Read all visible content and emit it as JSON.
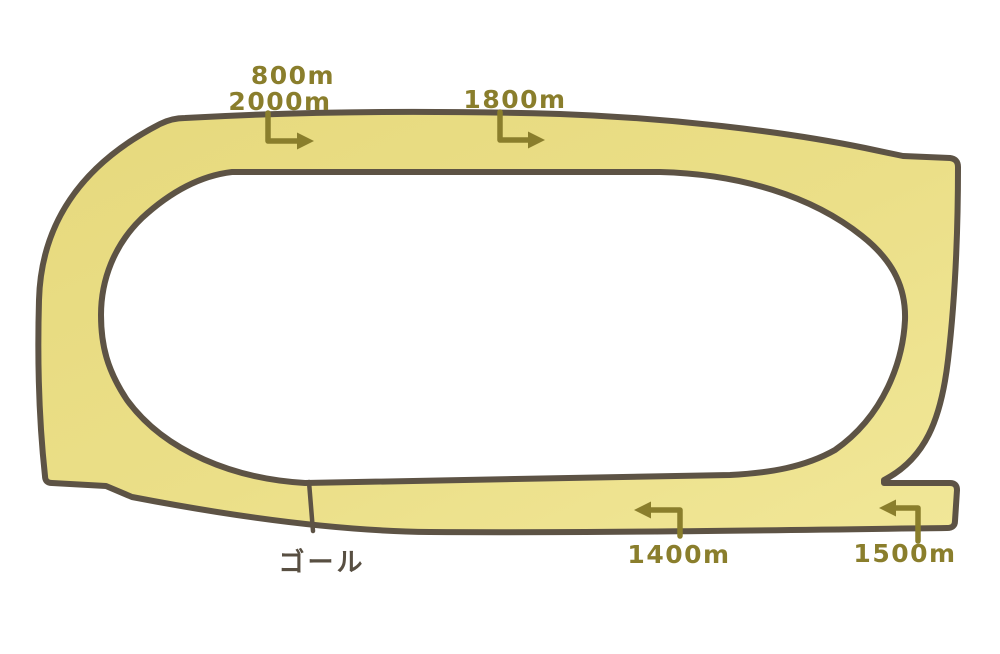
{
  "diagram": {
    "kind": "racecourse-track",
    "direction": "clockwise-top-right-to-left-bottom"
  },
  "colors": {
    "background": "#ffffff",
    "track_fill_dark": "#e6d97d",
    "track_fill_mid": "#ebdf88",
    "track_fill_light": "#f1e798",
    "outline": "#5d5345",
    "marker_text": "#8a7e2c",
    "goal_text": "#584f42"
  },
  "markers": {
    "m800": {
      "label": "800m"
    },
    "m2000": {
      "label": "2000m"
    },
    "m1800": {
      "label": "1800m"
    },
    "m1400": {
      "label": "1400m"
    },
    "m1500": {
      "label": "1500m"
    },
    "goal": {
      "label": "ゴール"
    }
  }
}
